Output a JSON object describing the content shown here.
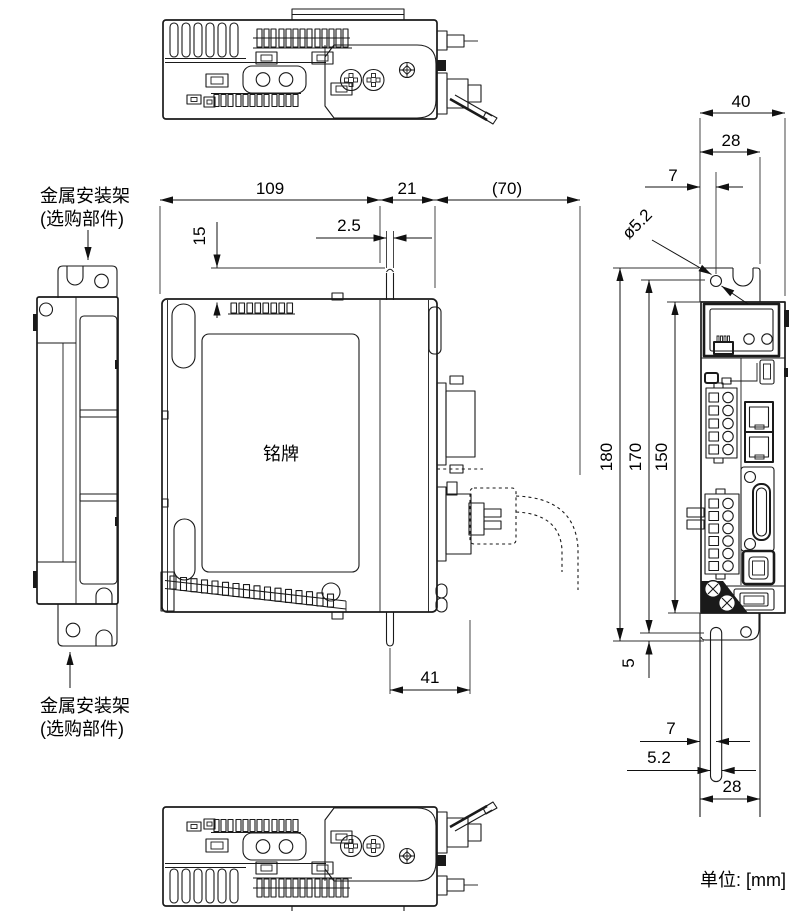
{
  "units_label": "单位: [mm]",
  "labels": {
    "bracket_top_line1": "金属安装架",
    "bracket_top_line2": "(选购部件)",
    "bracket_bottom_line1": "金属安装架",
    "bracket_bottom_line2": "(选购部件)",
    "nameplate": "铭牌"
  },
  "dimensions": {
    "side_depth_body": "109",
    "side_depth_front": "21",
    "side_cable_clearance": "(70)",
    "side_bracket_thickness": "2.5",
    "side_bracket_top_offset": "15",
    "side_bottom_clearance": "41",
    "front_width_total": "40",
    "front_bracket_width_top": "28",
    "front_hole_offset_top": "7",
    "front_hole_diameter": "ø5.2",
    "front_height_bracket": "180",
    "front_height_hole_to_bottom": "170",
    "front_height_body": "150",
    "front_bottom_step": "5",
    "front_slot_offset": "7",
    "front_slot_width": "5.2",
    "front_bracket_width_bottom": "28"
  }
}
